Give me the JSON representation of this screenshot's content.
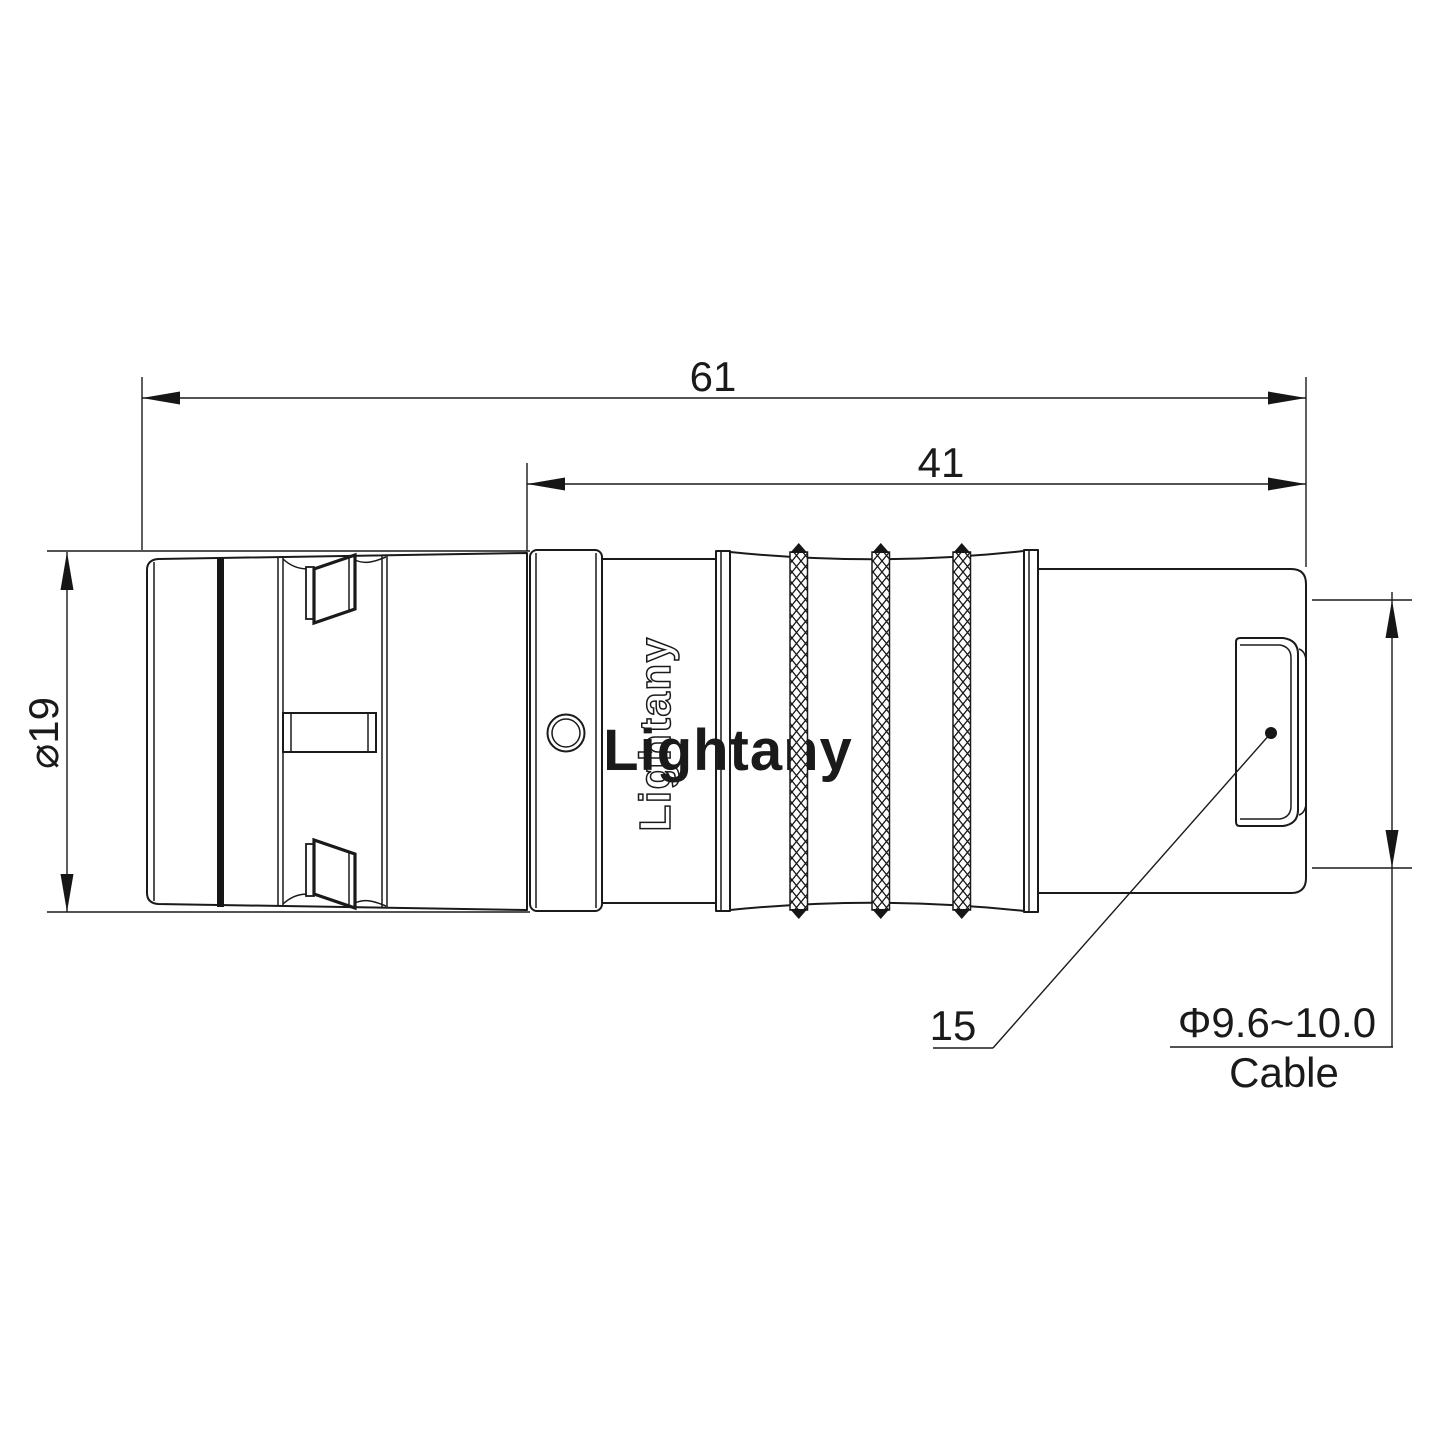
{
  "drawing": {
    "watermark": "Lightany",
    "body_engraving": "Lightany",
    "dimensions": {
      "overall_length": "61",
      "rear_section_length": "41",
      "shell_diameter": "⌀19",
      "bend_relief_item": "15",
      "cable_diameter_range": "Φ9.6~10.0",
      "cable_label": "Cable"
    },
    "colors": {
      "line": "#1a1a1a",
      "ink": "#161616",
      "watermark": "#f0b6b6",
      "background": "#ffffff"
    }
  }
}
